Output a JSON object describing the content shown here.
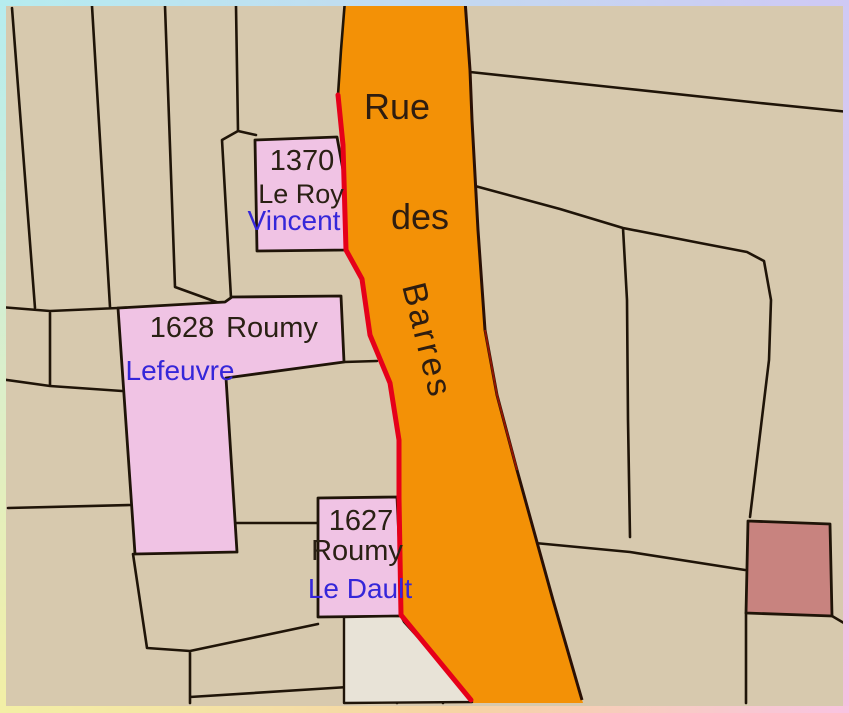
{
  "street": {
    "word1": "Rue",
    "word2": "des",
    "word3": "Barres",
    "full_name": "Rue des Barres"
  },
  "parcels": [
    {
      "number": "1370",
      "owner": "Le Roy",
      "occupant": "Vincent"
    },
    {
      "number": "1628",
      "owner": "Roumy",
      "occupant": "Lefeuvre"
    },
    {
      "number": "1627",
      "owner": "Roumy",
      "occupant": "Le Dault"
    }
  ],
  "colors": {
    "background_tan": "#d7c9ae",
    "street_orange": "#f39106",
    "street_alignment_red": "#e60019",
    "parcel_highlight_pink": "#f0c3e4",
    "parcel_unlabeled_mauve": "#c8837f",
    "building_offwhite": "#e8e3d7",
    "boundary_black": "#1f1408",
    "label_black": "#2a2014",
    "label_blue": "#3526d9",
    "frame_cyan": "#b6ecef",
    "frame_lavender": "#cfc9f4",
    "frame_pink": "#f6c0e2",
    "frame_yellow": "#f3efa5"
  }
}
